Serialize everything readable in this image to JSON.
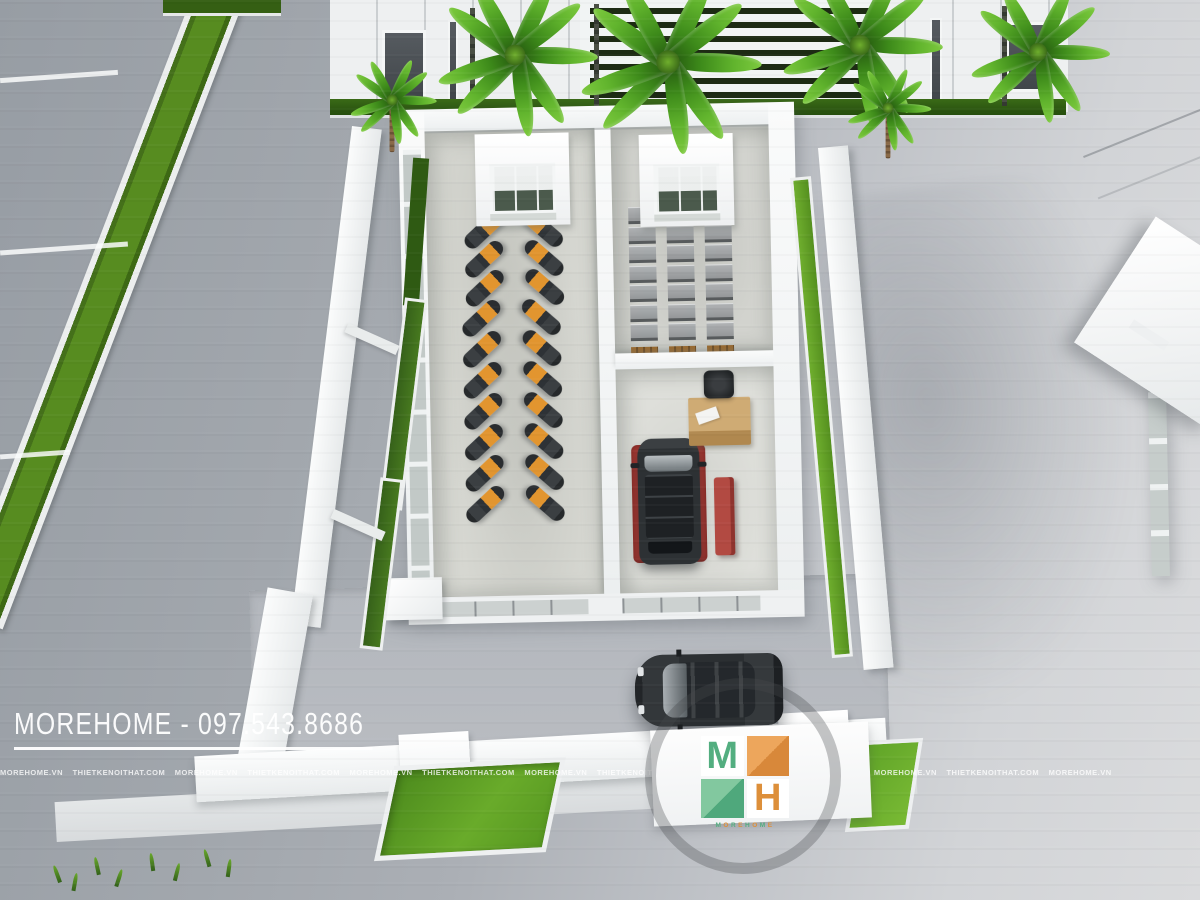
{
  "scene": {
    "type": "3d architectural aerial render",
    "subject": "motorbike showroom with warehouse, service bay and landscaped forecourt"
  },
  "watermark": {
    "main_text": "MOREHOME - 097.543.8686",
    "strip_text": "MOREHOME.VN    THIETKENOITHAT.COM    MOREHOME.VN    THIETKENOITHAT.COM    MOREHOME.VN    THIETKENOITHAT.COM    MOREHOME.VN    THIETKENOITHAT.COM    MOREHOME.VN    THIETKENOITHAT.COM    MOREHOME.VN    THIETKENOITHAT.COM    MOREHOME.VN"
  },
  "logo": {
    "letter_m": "M",
    "letter_h": "H",
    "wordmark": "MOREHOME",
    "green": "#53ae80",
    "orange": "#dd8f3a"
  },
  "colors": {
    "road": "#a4a9af",
    "plaza": "#d5d7d9",
    "grass_bright": "#6aae2d",
    "grass_dark": "#33601a",
    "building_white": "#f3f5f6",
    "interior_floor": "#d7d8d2",
    "bike_orange": "#e2952f",
    "lift_red": "#a83a34",
    "vehicle_dark": "#2d3134",
    "desk_wood": "#cfab74"
  },
  "objects": {
    "bike_rows_front_group": 3,
    "bike_rows_main_group": 7,
    "bikes_per_row": 2,
    "rack_rows": 3,
    "rack_boxes_per_row": 7,
    "palm_count": 6,
    "cars": [
      "suv-on-service-lift",
      "sedan-in-forecourt"
    ]
  }
}
